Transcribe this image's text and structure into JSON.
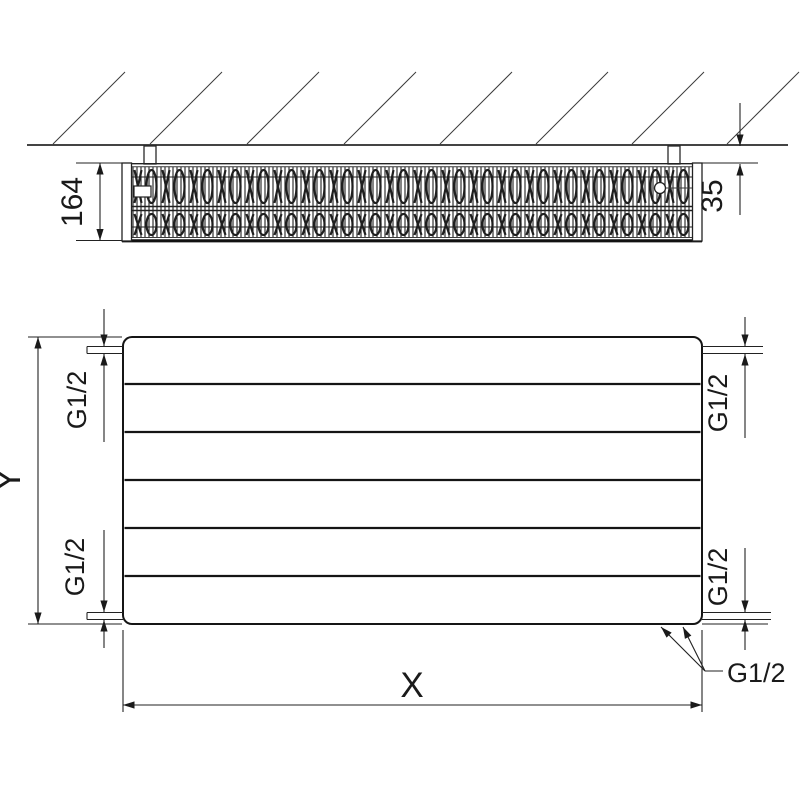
{
  "drawing": {
    "title": "panel-radiator-dimension-drawing",
    "line_color": "#1a1a1a",
    "background_color": "#ffffff",
    "top_view": {
      "depth_label": "164",
      "wall_gap_label": "35"
    },
    "front_view": {
      "height_label": "Y",
      "width_label": "X",
      "panel_rows": 6,
      "groove_count": 5,
      "connection_top_left": "G1/2",
      "connection_bottom_left": "G1/2",
      "connection_top_right": "G1/2",
      "connection_bottom_right": "G1/2",
      "connection_bottom_callout": "G1/2"
    }
  }
}
